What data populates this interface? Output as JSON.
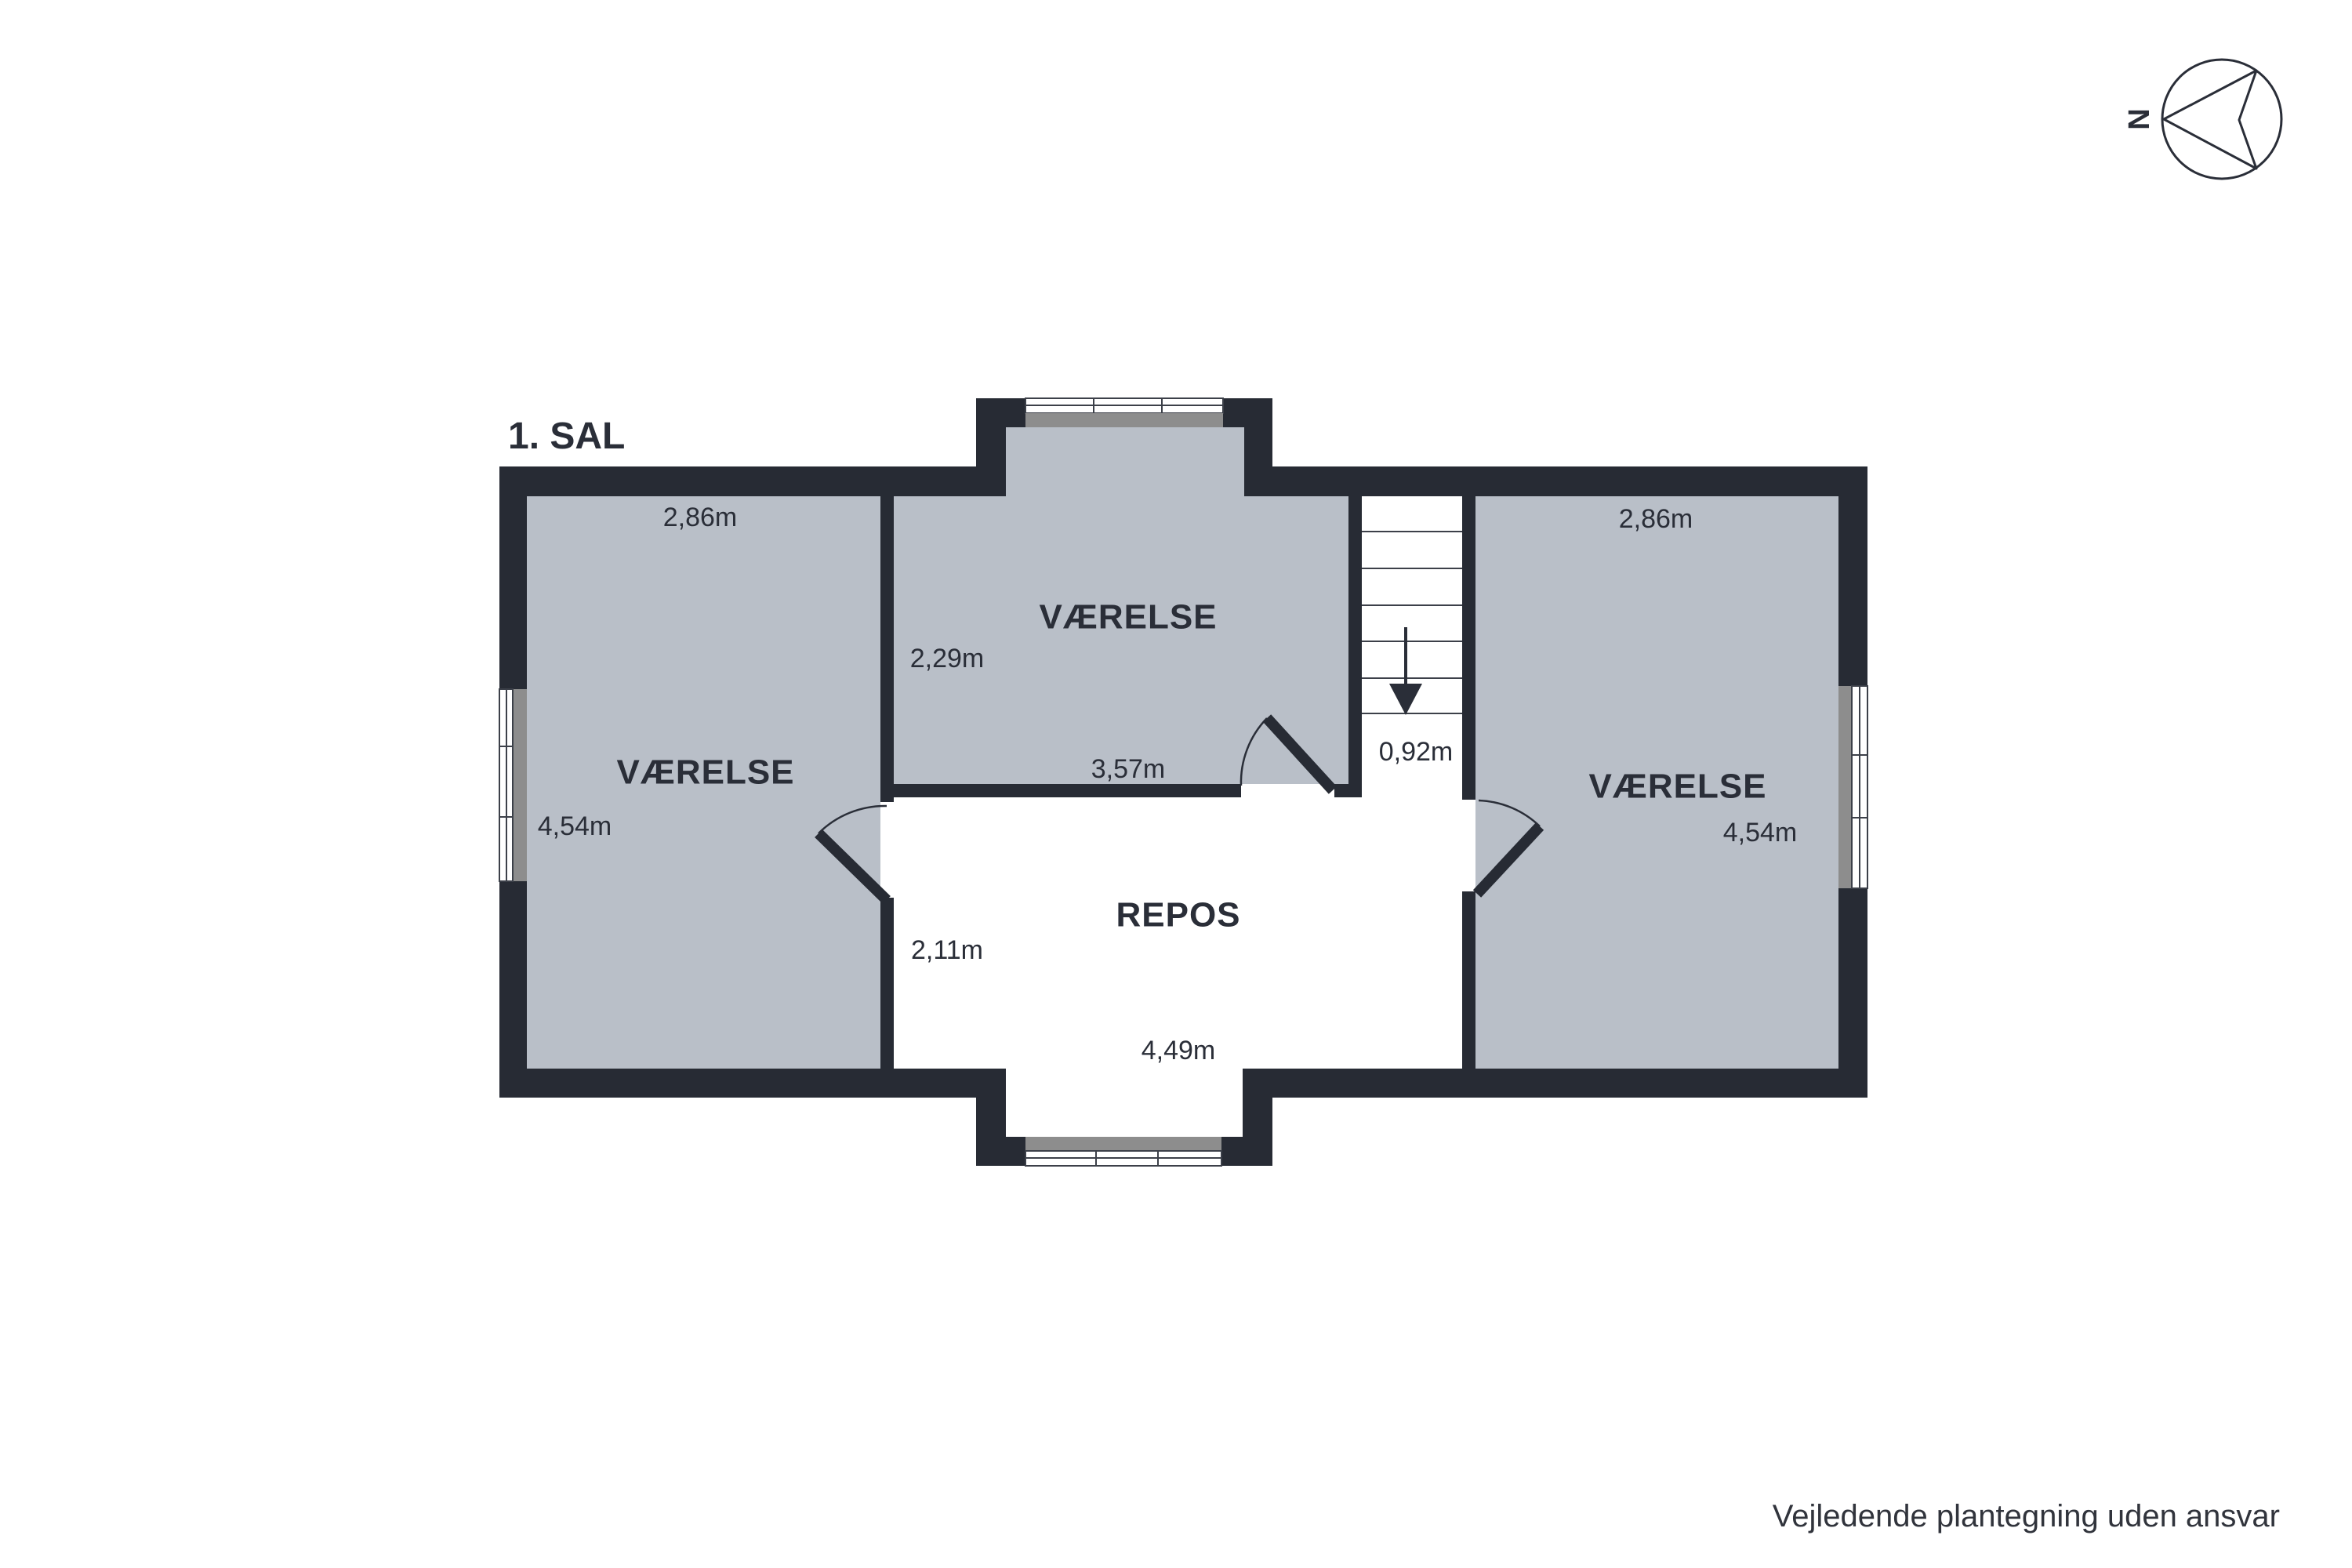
{
  "title": "1. SAL",
  "compass": {
    "label": "N"
  },
  "disclaimer": "Vejledende plantegning uden ansvar",
  "rooms": {
    "left": {
      "name": "VÆRELSE",
      "width": "2,86m",
      "depth": "4,54m"
    },
    "middle": {
      "name": "VÆRELSE",
      "width": "3,57m",
      "depth": "2,29m"
    },
    "right": {
      "name": "VÆRELSE",
      "width": "2,86m",
      "depth": "4,54m"
    },
    "repos": {
      "name": "REPOS",
      "width": "4,49m",
      "depth": "2,11m"
    },
    "stairs": {
      "width": "0,92m",
      "direction": "down"
    }
  },
  "colors": {
    "wall": "#272b34",
    "room_fill": "#b9bfc8",
    "sill": "#8d8d8d",
    "text": "#2a2e38"
  }
}
